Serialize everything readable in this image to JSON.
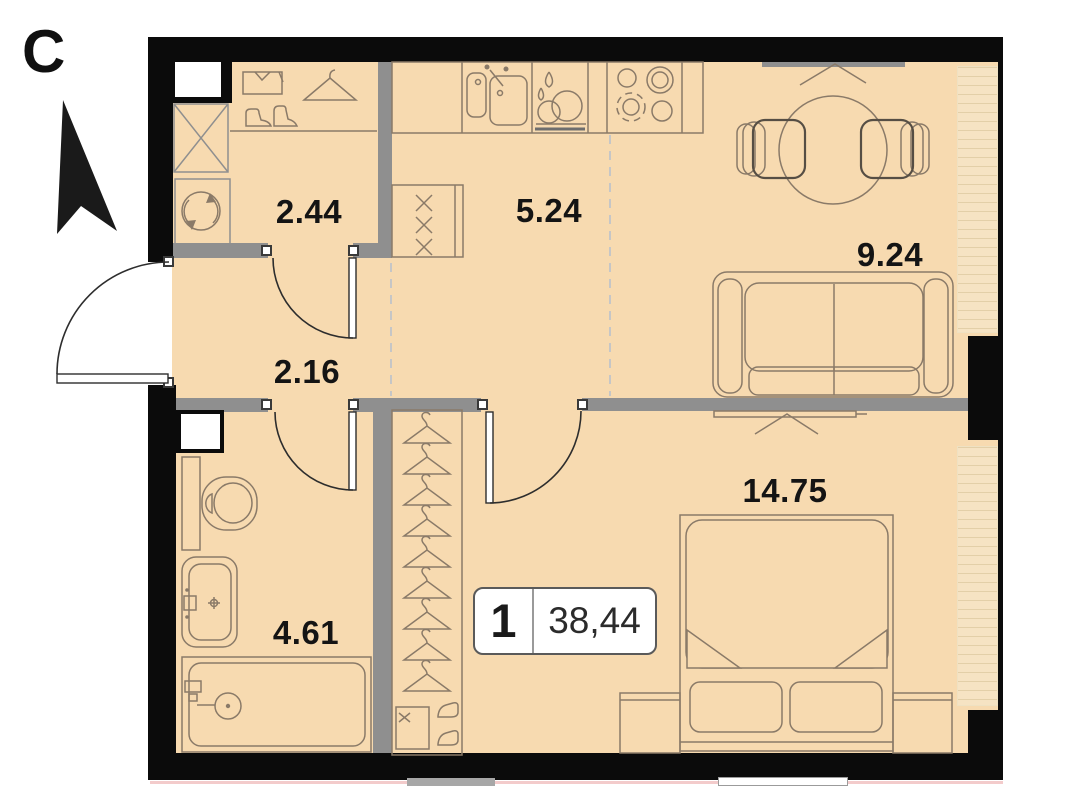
{
  "compass": {
    "letter": "С"
  },
  "badge": {
    "rooms_count": "1",
    "total_area": "38,44"
  },
  "rooms": [
    {
      "id": "entry-storage",
      "area": "2.44"
    },
    {
      "id": "kitchen",
      "area": "5.24"
    },
    {
      "id": "living-area",
      "area": "9.24"
    },
    {
      "id": "hallway",
      "area": "2.16"
    },
    {
      "id": "bathroom",
      "area": "4.61"
    },
    {
      "id": "bedroom",
      "area": "14.75"
    }
  ],
  "colors": {
    "floor": "#F7DAB0",
    "walls": "#0B0B0B",
    "partitions": "#8F8F8F",
    "furniture_lines": "#8A7A68",
    "door_lines": "#2D2D2D",
    "underlay_line": "#F3CBCB"
  },
  "icons": {
    "north-arrow": "filled arrow pointing up",
    "hanger": "clothes hanger",
    "shirt": "folded shirt",
    "boots": "pair of boots",
    "washing-machine": "drum with rotation arrows",
    "vent-shaft": "box with diagonal cross",
    "kitchen-sink": "double basin with tap",
    "dish-rack": "plates with water drops",
    "stove": "four burner rings",
    "fridge": "tall cabinet with x marks",
    "dining-table": "round table",
    "chair": "seat with double back line",
    "sofa": "two-seat sofa",
    "bed": "double bed with folded blanket and pillows",
    "nightstand": "bedside table",
    "toilet": "bowl with cistern",
    "wash-basin": "basin with mixer",
    "bathtub": "tub with hand shower",
    "window": "sill line with opening chevron",
    "door": "leaf with quarter-circle swing"
  }
}
